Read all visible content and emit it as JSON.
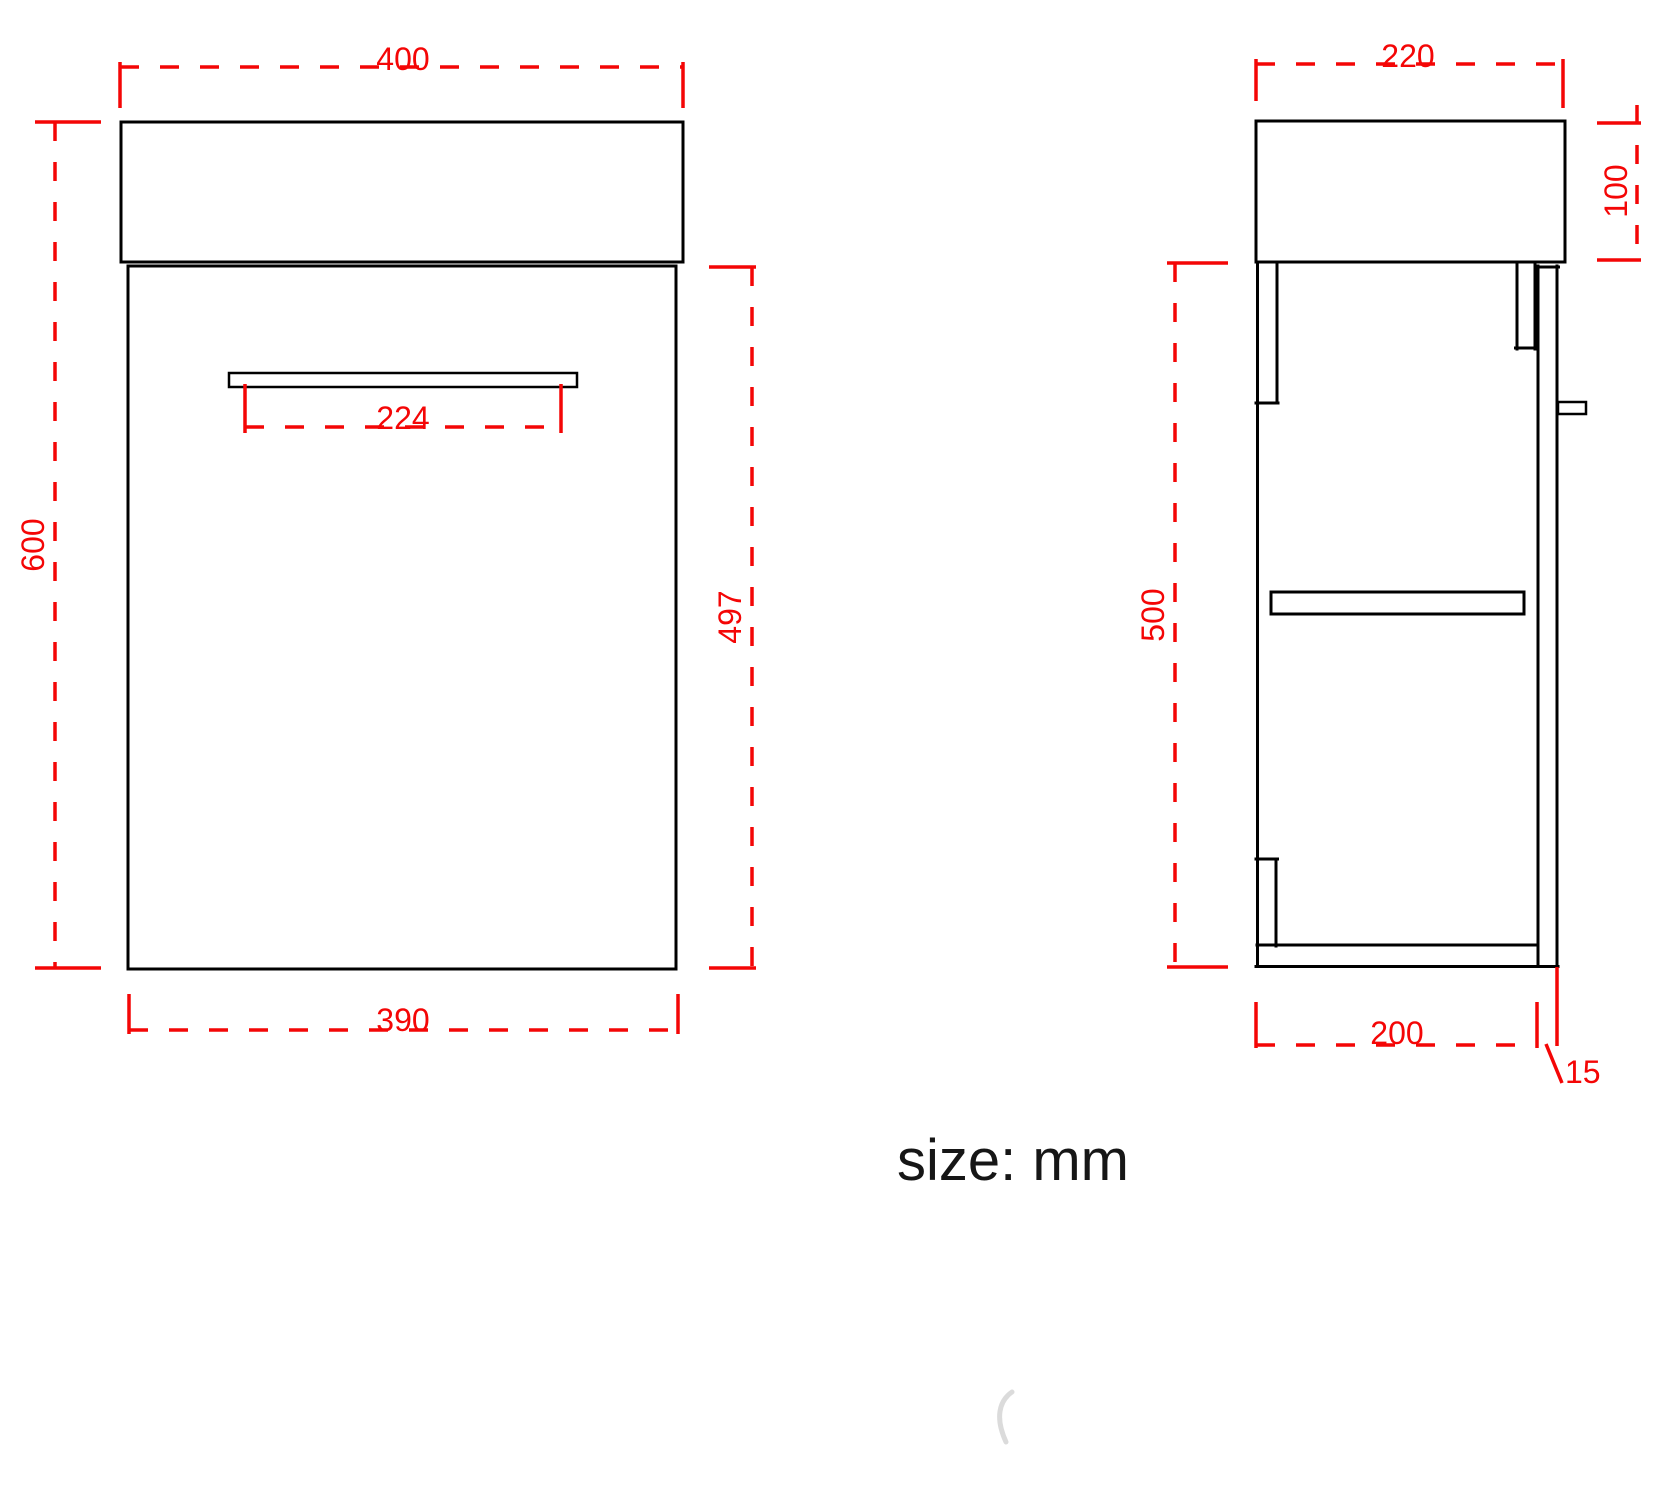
{
  "note": "size: mm",
  "colors": {
    "dimension_red": "#f40606",
    "outline_black": "#000000",
    "background": "#ffffff"
  },
  "front_view": {
    "name": "front elevation of wall-hung vanity with basin",
    "dim_width_top": "400",
    "dim_height_left": "600",
    "dim_handle_width": "224",
    "dim_cabinet_height_right": "497",
    "dim_width_bottom": "390"
  },
  "side_view": {
    "name": "side section of vanity cabinet",
    "dim_depth_top": "220",
    "dim_basin_height_right": "100",
    "dim_cabinet_height_left": "500",
    "dim_depth_bottom": "200",
    "dim_door_thickness": "15"
  }
}
